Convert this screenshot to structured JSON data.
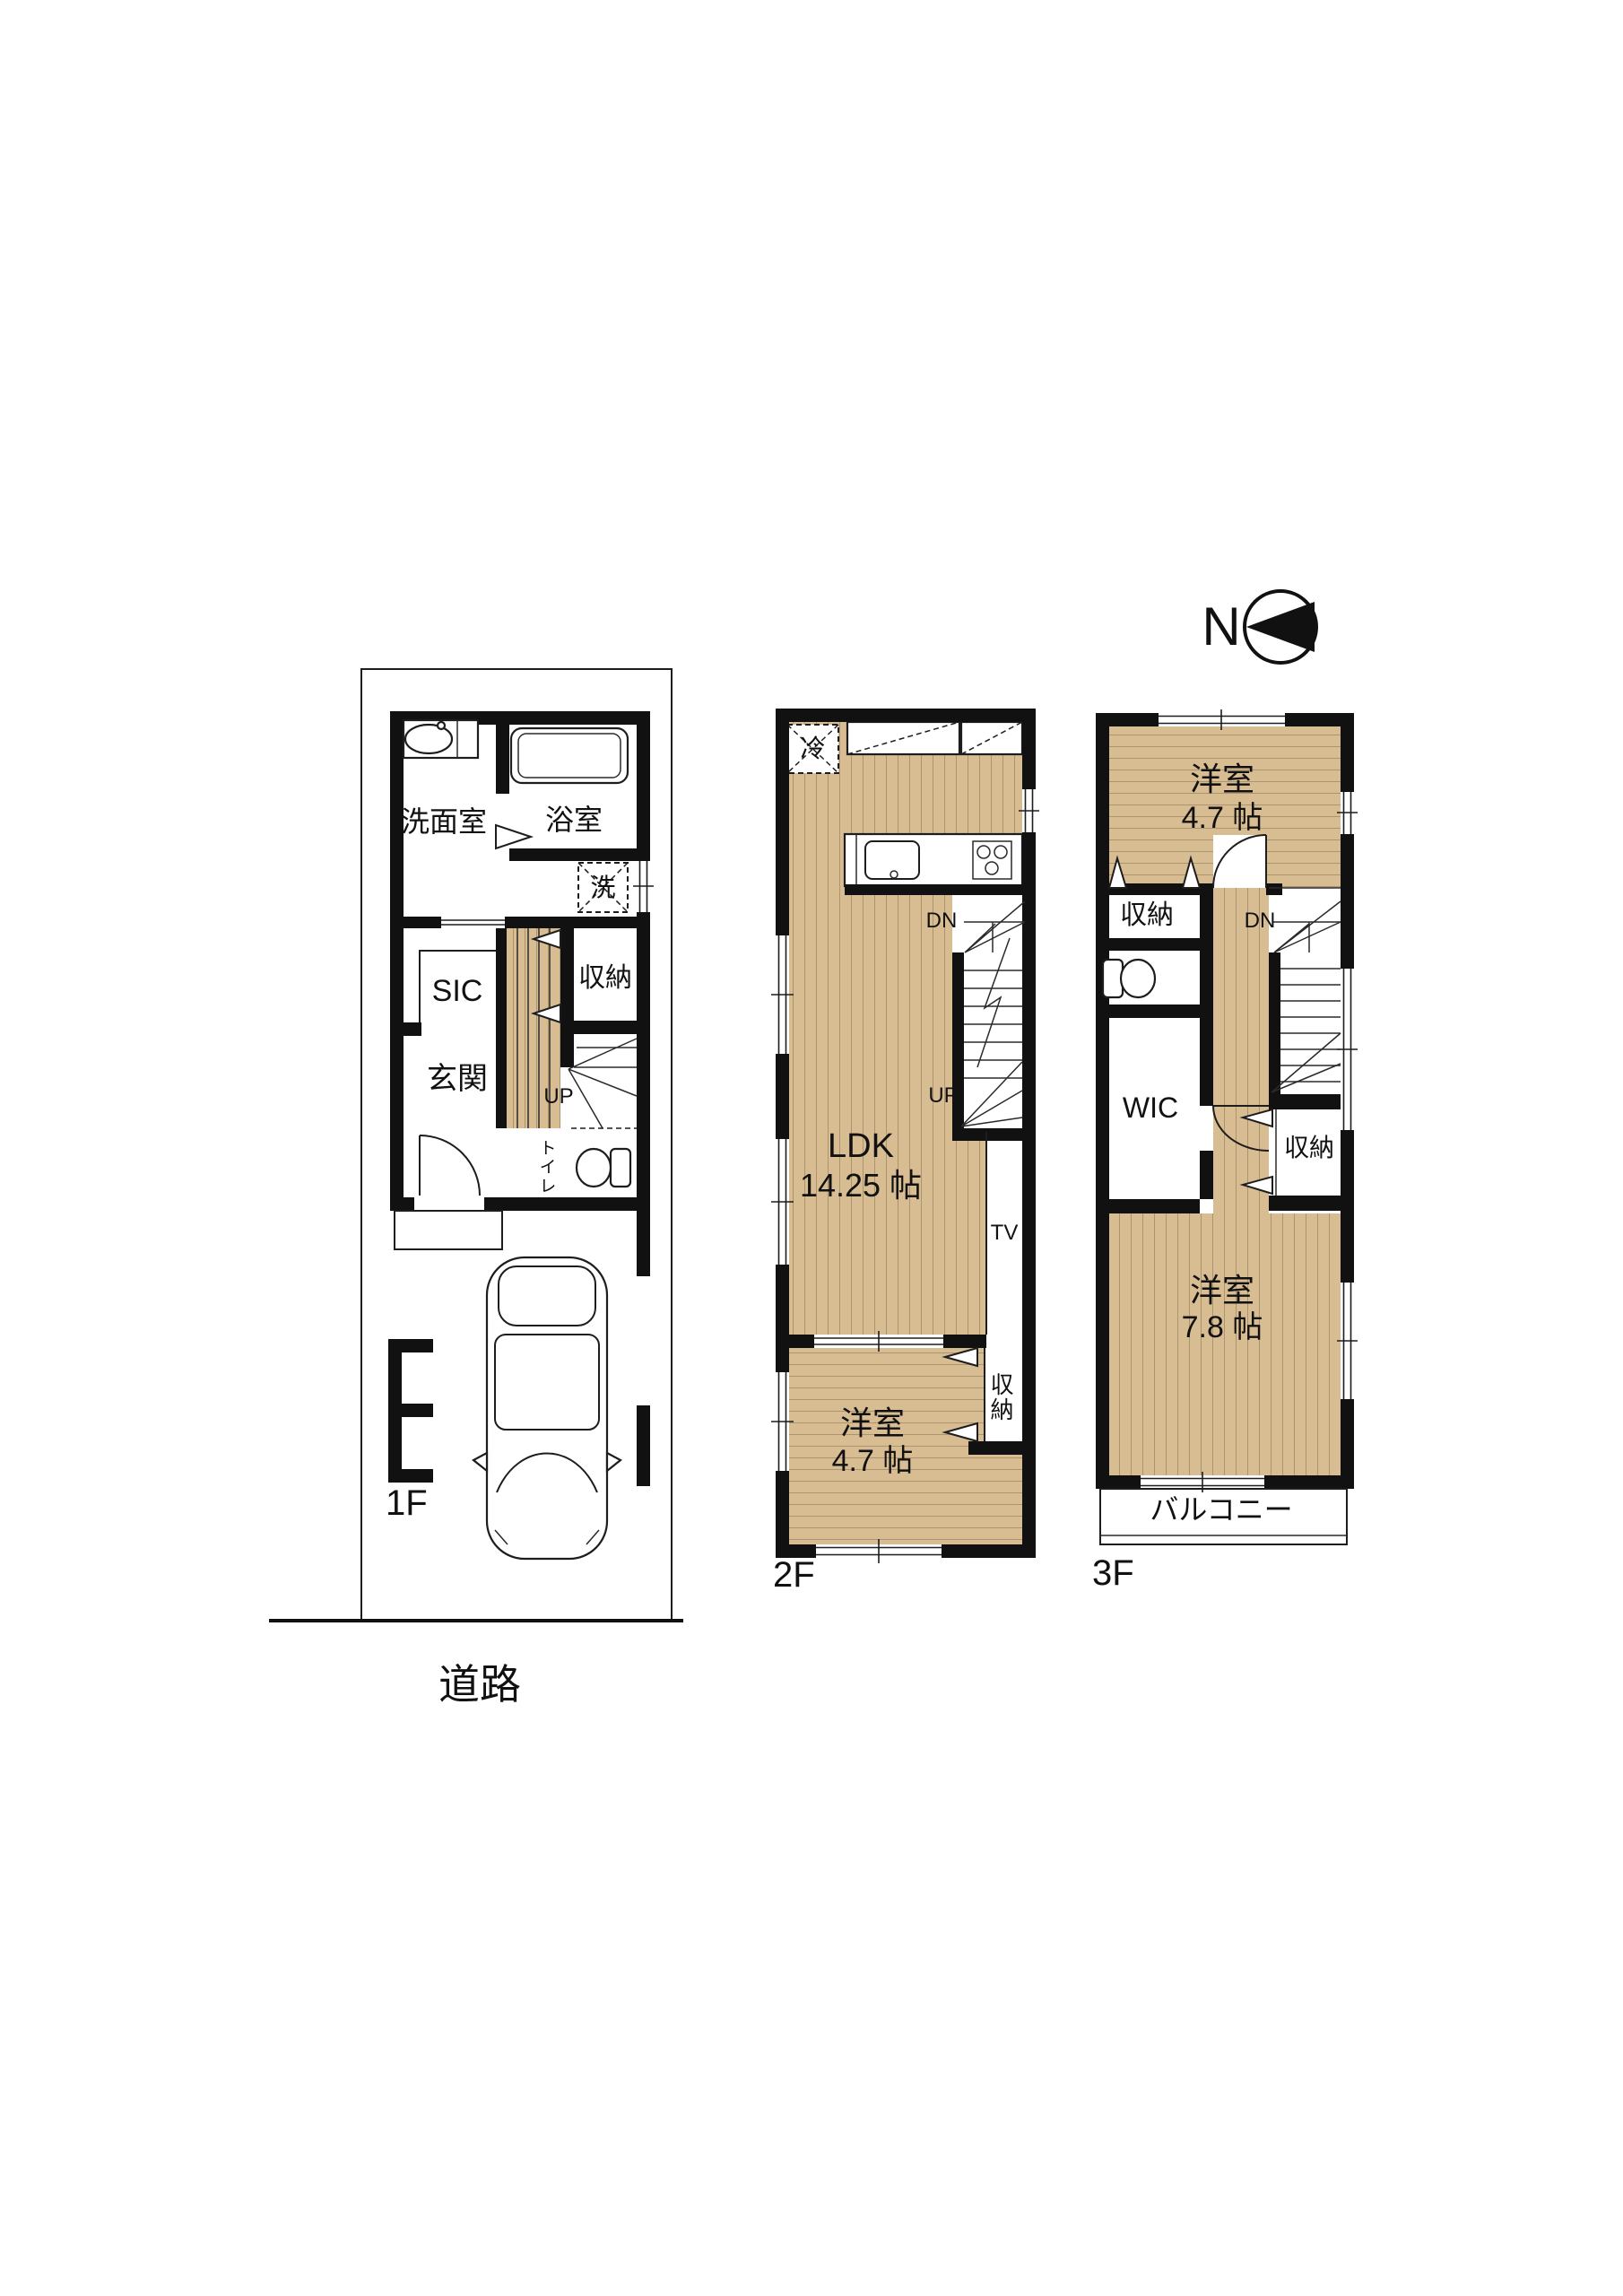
{
  "compass": {
    "label": "N"
  },
  "road": {
    "label": "道路"
  },
  "colors": {
    "floor": "#D8BC92",
    "stripe": "#AD9470",
    "wall": "#111111"
  },
  "floor1": {
    "name": "1F",
    "rooms": {
      "washroom": "洗面室",
      "bathroom": "浴室",
      "washer": "洗",
      "sic": "SIC",
      "entrance": "玄関",
      "storage": "収納",
      "stairs_up": "UP",
      "toilet": "トイレ"
    }
  },
  "floor2": {
    "name": "2F",
    "rooms": {
      "fridge": "冷",
      "ldk": "LDK",
      "ldk_size": "14.25 帖",
      "stairs_down": "DN",
      "stairs_up": "UP",
      "tv": "TV",
      "storage": "収納",
      "bedroom": "洋室",
      "bedroom_size": "4.7 帖"
    }
  },
  "floor3": {
    "name": "3F",
    "rooms": {
      "bedroom_north": "洋室",
      "bedroom_north_size": "4.7 帖",
      "storage_north": "収納",
      "stairs_down": "DN",
      "wic": "WIC",
      "storage_mid": "収納",
      "bedroom_south": "洋室",
      "bedroom_south_size": "7.8 帖",
      "balcony": "バルコニー"
    }
  }
}
